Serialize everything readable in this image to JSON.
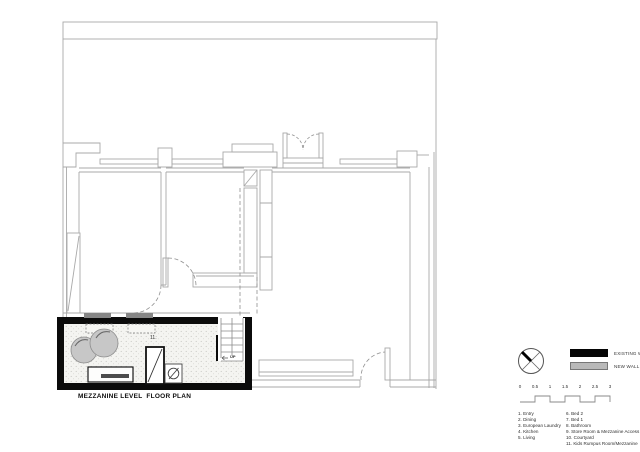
{
  "title": "MEZZANINE LEVEL  FLOOR PLAN",
  "plan": {
    "room_number_label": "11.",
    "stairs_label": "UP"
  },
  "icons": {
    "north": "north-arrow-icon"
  },
  "legend": {
    "items": [
      {
        "label": "EXISTING WALL",
        "color": "#000000"
      },
      {
        "label": "NEW WALL",
        "color": "#b9b9b9"
      }
    ]
  },
  "scale_bar": {
    "unit_ticks": [
      "0",
      "0.5",
      "1",
      "1.5",
      "2",
      "2.5",
      "3"
    ]
  },
  "room_schedule": {
    "column1": [
      "1. Entry",
      "2. Dining",
      "3. European Laundry",
      "4. Kitchen",
      "5. Living"
    ],
    "column2": [
      "6. Bed 2",
      "7. Bed 1",
      "8. Bathroom",
      "9. Store Room & Mezzanine Access",
      "10. Courtyard",
      "11. Kids Rumpus Room/Mezzanine"
    ]
  }
}
